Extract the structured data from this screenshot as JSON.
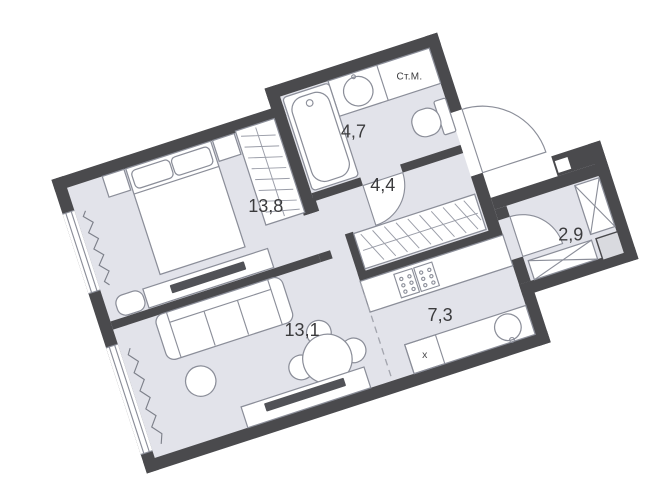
{
  "floor_plan": {
    "rooms": [
      {
        "id": "bedroom",
        "area_label": "13,8"
      },
      {
        "id": "bathroom",
        "area_label": "4,7"
      },
      {
        "id": "hallway",
        "area_label": "4,4"
      },
      {
        "id": "living-room",
        "area_label": "13,1"
      },
      {
        "id": "kitchen",
        "area_label": "7,3"
      },
      {
        "id": "storage",
        "area_label": "2,9"
      }
    ],
    "labels": {
      "washing_machine": "Ст.М.",
      "kitchen_unit_x": "x"
    },
    "colors": {
      "wall": "#4a4a4d",
      "floor": "#e2e3ea",
      "furniture_stroke": "#8b8e99",
      "label_text": "#3b3b3d"
    }
  }
}
